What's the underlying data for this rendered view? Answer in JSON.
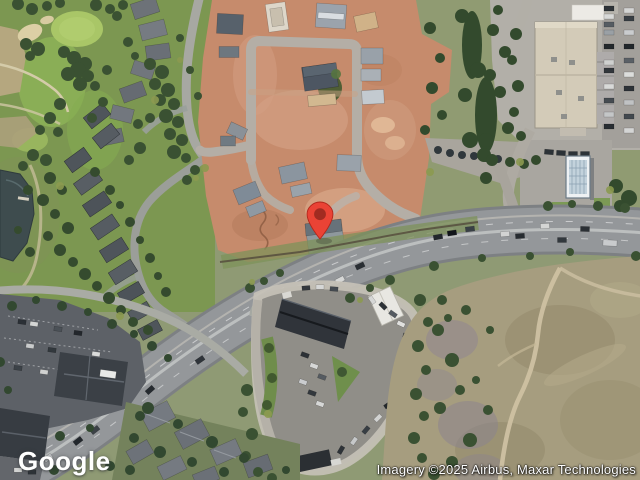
{
  "map": {
    "marker": {
      "fill": "#EA4335",
      "dot": "#A12B21"
    }
  },
  "branding": {
    "logo_text": "Google",
    "logo_color": "#FFFFFF"
  },
  "attribution": {
    "text": "Imagery ©2025 Airbus, Maxar Technologies",
    "text_color": "#FFFFFF"
  }
}
